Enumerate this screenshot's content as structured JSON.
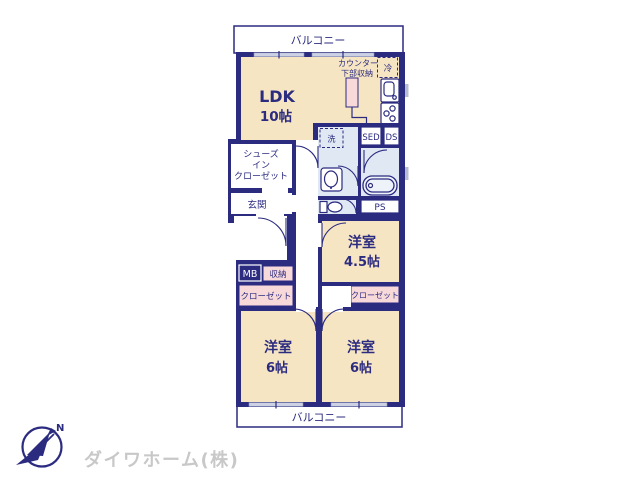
{
  "meta": {
    "type": "apartment-floor-plan"
  },
  "colors": {
    "wall_navy": "#2b2b80",
    "room_beige": "#f6e5c3",
    "closet_pink": "#f8d9da",
    "water_blue": "#dfe8f3",
    "window_lavender": "#cdd1e4",
    "logo_gray": "#c8c8c8"
  },
  "balconies": {
    "top": "バルコニー",
    "bottom": "バルコニー"
  },
  "rooms": {
    "ldk": {
      "label": "LDK",
      "size": "10帖"
    },
    "bedroom_45": {
      "label": "洋室",
      "size": "4.5帖"
    },
    "bedroom_6_left": {
      "label": "洋室",
      "size": "6帖"
    },
    "bedroom_6_right": {
      "label": "洋室",
      "size": "6帖"
    },
    "entrance": {
      "label": "玄関"
    },
    "shoes_in_closet": {
      "line1": "シューズ",
      "line2": "イン",
      "line3": "クローゼット"
    }
  },
  "labels": {
    "counter_line1": "カウンター",
    "counter_line2": "下部収納",
    "fridge": "冷",
    "washer": "洗",
    "sed": "SED",
    "ds": "DS",
    "ps": "PS",
    "mb": "MB",
    "storage": "収納",
    "closet_left": "クローゼット",
    "closet_right": "クローゼット"
  },
  "footer": {
    "company": "ダイワホーム(株)",
    "compass_north": "N"
  }
}
